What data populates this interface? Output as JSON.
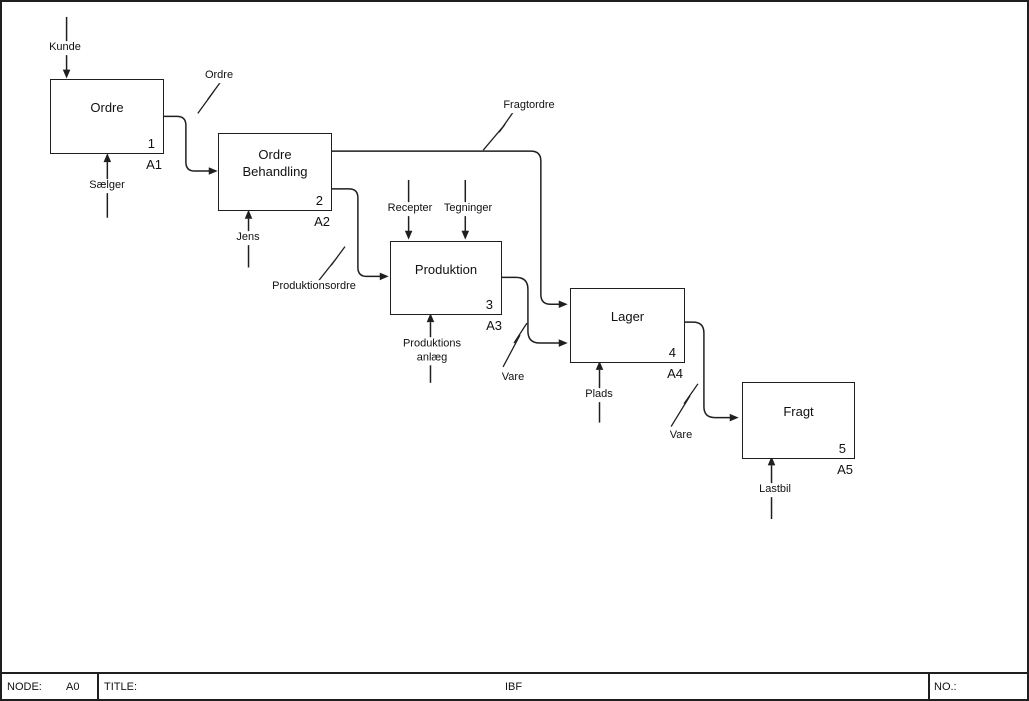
{
  "diagram": {
    "node": "A0",
    "activities": [
      {
        "label": "Ordre",
        "num": "1",
        "code": "A1"
      },
      {
        "label": "Ordre Behandling",
        "num": "2",
        "code": "A2"
      },
      {
        "label": "Produktion",
        "num": "3",
        "code": "A3"
      },
      {
        "label": "Lager",
        "num": "4",
        "code": "A4"
      },
      {
        "label": "Fragt",
        "num": "5",
        "code": "A5"
      }
    ],
    "flow_labels": {
      "kunde": "Kunde",
      "ordre": "Ordre",
      "saelger": "Sælger",
      "jens": "Jens",
      "fragtordre": "Fragtordre",
      "produktionsordre": "Produktionsordre",
      "recepter": "Recepter",
      "tegninger": "Tegninger",
      "produktionsanlaeg": "Produktions anlæg",
      "vare_til_lager": "Vare",
      "plads": "Plads",
      "vare_til_fragt": "Vare",
      "lastbil": "Lastbil"
    },
    "line_color": "#1f1f1f"
  },
  "footer": {
    "node_label": "NODE:",
    "node_value": "A0",
    "title_label": "TITLE:",
    "title_value": "IBF",
    "no_label": "NO.:"
  }
}
